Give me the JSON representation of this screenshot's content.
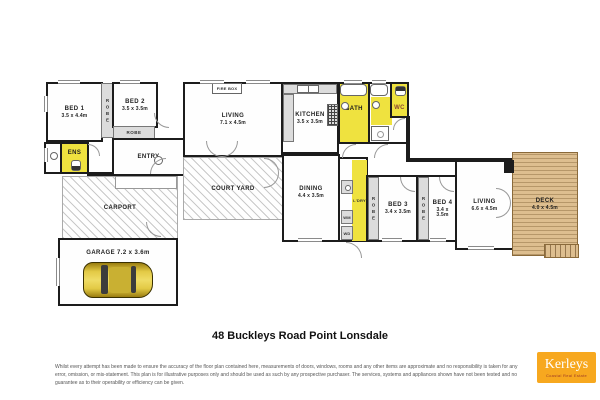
{
  "title": "48 Buckleys Road Point Lonsdale",
  "rooms": {
    "bed1": {
      "label": "BED 1",
      "dims": "3.5 x 4.4m"
    },
    "bed2": {
      "label": "BED 2",
      "dims": "3.5 x 3.5m"
    },
    "bed3": {
      "label": "BED 3",
      "dims": "3.4 x 3.5m"
    },
    "bed4": {
      "label": "BED 4",
      "dims": "3.4 x 3.5m"
    },
    "living_main": {
      "label": "LIVING",
      "dims": "7.1 x 4.5m"
    },
    "living_rear": {
      "label": "LIVING",
      "dims": "6.6 x 4.5m"
    },
    "kitchen": {
      "label": "KITCHEN",
      "dims": "3.5 x 3.5m"
    },
    "dining": {
      "label": "DINING",
      "dims": "4.4 x 3.5m"
    },
    "deck": {
      "label": "DECK",
      "dims": "4.0 x 4.5m"
    },
    "courtyard": {
      "label": "COURT YARD"
    },
    "carport": {
      "label": "CARPORT"
    },
    "garage": {
      "label": "GARAGE 7.2 x 3.6m"
    },
    "entry": {
      "label": "ENTRY"
    },
    "ens": {
      "label": "ENS"
    },
    "bath": {
      "label": "BATH"
    },
    "wc": {
      "label": "WC"
    },
    "laundry": {
      "label": "L'DRY"
    },
    "robe": {
      "label": "ROBE"
    },
    "firebox": {
      "label": "FIRE BOX"
    },
    "wm": {
      "label": "WM"
    },
    "wd": {
      "label": "WD"
    }
  },
  "footer": {
    "disclaimer": "Whilst every attempt has been made to ensure the accuracy of the floor plan contained here, measurements of doors, windows, rooms and any other items are approximate and no responsibility is taken for any error, omission, or mis-statement. This plan is for illustrative purposes only and should be used as such by any prospective purchaser. The services, systems and appliances shown have not been tested and no guarantee as to their operability or efficiency can be given."
  },
  "logo": {
    "name": "Kerleys",
    "tagline": "Coastal Real Estate"
  },
  "colors": {
    "wall": "#1c1c1c",
    "wet_area": "#EFE23F",
    "deck": "#DDBE8F",
    "logo_bg": "#F7A81F"
  }
}
